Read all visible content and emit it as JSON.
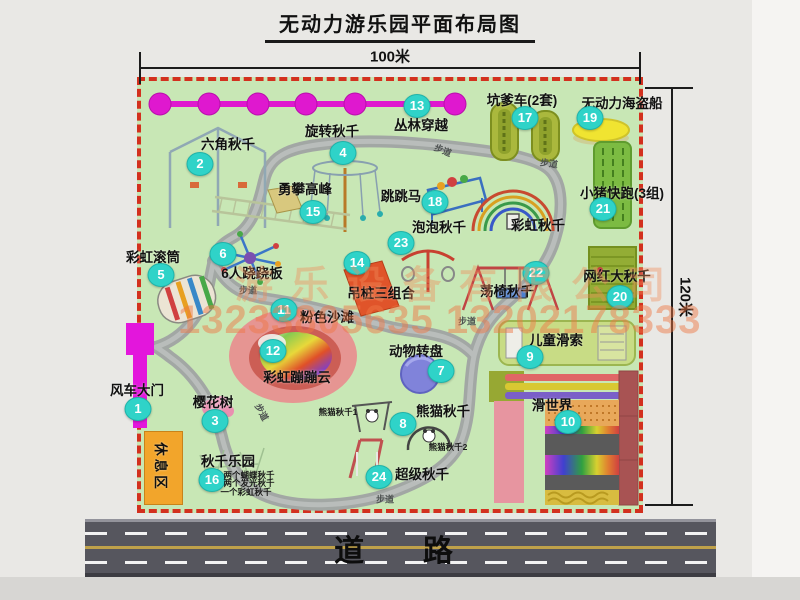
{
  "title": "无动力游乐园平面布局图",
  "dimensions": {
    "width_label": "100米",
    "height_label": "120米"
  },
  "road": {
    "label": "道  路"
  },
  "watermark": {
    "company": "游乐设备有限公司",
    "phone": "13233805635 13202178333"
  },
  "map": {
    "rest_area_label": "休息区",
    "path_label": "步道",
    "rainbow_swing_label": "彩虹秋千",
    "panda_swing_1": "熊猫秋千1",
    "panda_swing_2": "熊猫秋千2",
    "swing_park_notes": [
      "两个蝴蝶秋千",
      "两个发光秋千",
      "一个彩虹秋千"
    ]
  },
  "attractions": [
    {
      "num": "1",
      "label": "风车大门"
    },
    {
      "num": "2",
      "label": "六角秋千"
    },
    {
      "num": "3",
      "label": "樱花树"
    },
    {
      "num": "4",
      "label": "旋转秋千"
    },
    {
      "num": "5",
      "label": "彩虹滚筒"
    },
    {
      "num": "6",
      "label": "6人跷跷板"
    },
    {
      "num": "7",
      "label": "动物转盘"
    },
    {
      "num": "8",
      "label": "熊猫秋千"
    },
    {
      "num": "9",
      "label": "儿童滑索"
    },
    {
      "num": "10",
      "label": "滑世界"
    },
    {
      "num": "11",
      "label": "粉色沙滩"
    },
    {
      "num": "12",
      "label": "彩虹蹦蹦云"
    },
    {
      "num": "13",
      "label": "丛林穿越"
    },
    {
      "num": "14",
      "label": "吊桩三组合"
    },
    {
      "num": "15",
      "label": "勇攀高峰"
    },
    {
      "num": "16",
      "label": "秋千乐园"
    },
    {
      "num": "17",
      "label": "坑爹车(2套)"
    },
    {
      "num": "18",
      "label": "跳跳马"
    },
    {
      "num": "19",
      "label": "无动力海盗船"
    },
    {
      "num": "20",
      "label": "网红大秋千"
    },
    {
      "num": "21",
      "label": "小猪快跑(3组)"
    },
    {
      "num": "22",
      "label": "荡椅秋千"
    },
    {
      "num": "23",
      "label": "泡泡秋千"
    },
    {
      "num": "24",
      "label": "超级秋千"
    }
  ],
  "colors": {
    "map_green": "#c8e7b5",
    "border_red": "#d3301e",
    "badge_teal": "#2fd3c8",
    "chain_magenta": "#df18cf",
    "path_gray": "#a2a7a4",
    "rest_area_orange": "#f2a52b",
    "road_gray": "#56565e"
  }
}
